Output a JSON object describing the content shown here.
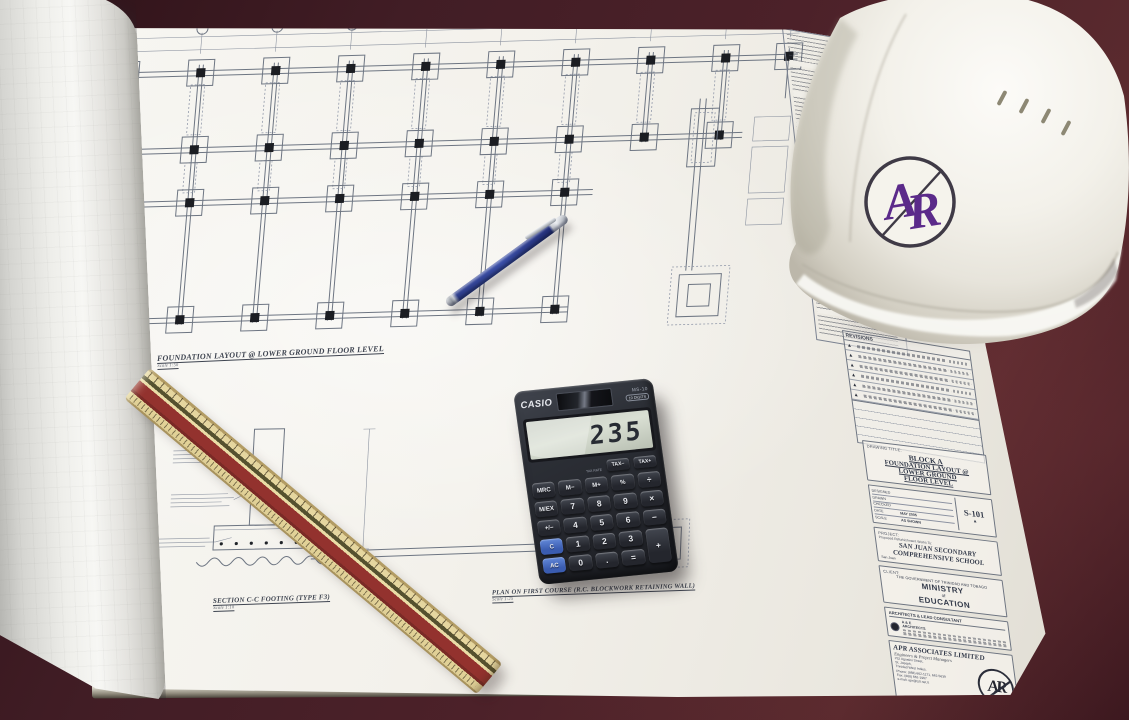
{
  "blueprint": {
    "plan_caption": "FOUNDATION LAYOUT @ LOWER GROUND FLOOR LEVEL",
    "plan_caption_scale": "Scale 1:50",
    "section_caption": "SECTION C-C FOOTING (TYPE F3)",
    "section_caption_scale": "Scale 1:10",
    "retaining_caption": "PLAN ON FIRST COURSE (R.C. BLOCKWORK RETAINING WALL)",
    "retaining_caption_scale": "Scale 1:25",
    "title_block": {
      "revisions_label": "REVISIONS",
      "revision_marks": [
        "▲",
        "▲",
        "▲",
        "▲",
        "▲",
        "▲"
      ],
      "drawing_title_label": "DRAWING TITLE:",
      "drawing_title_line1": "BLOCK A",
      "drawing_title_line2": "FOUNDATION LAYOUT @",
      "drawing_title_line3": "LOWER GROUND",
      "drawing_title_line4": "FLOOR LEVEL",
      "designed_label": "DESIGNED",
      "drawn_label": "DRAWN",
      "checked_label": "CHECKED",
      "date_label": "DATE",
      "date_value": "MAY 2005",
      "scale_label": "SCALE",
      "scale_value": "AS SHOWN",
      "drawing_number": "S-101",
      "drawing_number_mark": "▲",
      "project_label": "PROJECT:",
      "project_intro": "Proposed Refurbishment Works To:",
      "project_line1": "SAN JUAN SECONDARY",
      "project_line2": "COMPREHENSIVE SCHOOL",
      "project_location": "San Juan",
      "client_label": "CLIENT:",
      "client_intro": "THE GOVERNMENT OF TRINIDAD AND TOBAGO",
      "client_line1": "MINISTRY",
      "client_line2": "of",
      "client_line3": "EDUCATION",
      "consultant_label": "ARCHITECTS & LEAD CONSULTANT",
      "consultant_line1": "A & E",
      "consultant_line2": "ARCHITECTS",
      "firm_name": "APR ASSOCIATES LIMITED",
      "firm_tagline": "Engineers & Project Managers",
      "firm_address1": "#32 Agostini Street,",
      "firm_address2": "St. Joseph,",
      "firm_address3": "Trinidad West Indies.",
      "firm_address4": "Phone: (868) 662-1171, 662-5639",
      "firm_address5": "Fax: (868) 662-1967",
      "firm_address6": "e-mail: apr@tstt.net.tt",
      "firm_logo_text": "AR"
    }
  },
  "calculator": {
    "brand": "CASIO",
    "model": "MS-10",
    "digits_badge": "10 DIGITS",
    "display_value": "235",
    "tax_rate_label": "TAX RATE",
    "tax_keys": [
      "TAX−",
      "TAX+"
    ],
    "keys": [
      "MRC",
      "M−",
      "M+",
      "%",
      "÷",
      "M/EX",
      "7",
      "8",
      "9",
      "×",
      "+/−",
      "4",
      "5",
      "6",
      "−",
      "C",
      "1",
      "2",
      "3",
      "+",
      "AC",
      "0",
      ".",
      "="
    ]
  },
  "hardhat": {
    "logo_text": "AR"
  }
}
